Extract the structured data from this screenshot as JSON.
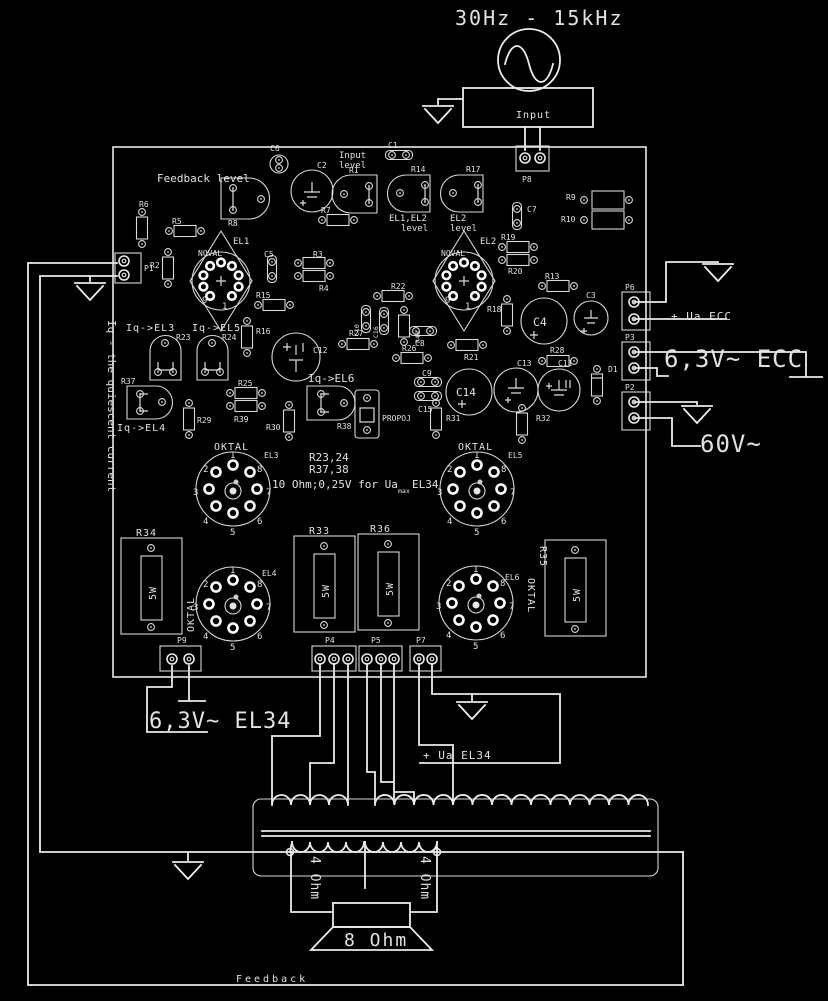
{
  "top": {
    "range": "30Hz - 15kHz",
    "source_label": "Input"
  },
  "right": {
    "ua_ecc": "+ Ua ECC",
    "heater_ecc": "6,3V~ ECC",
    "bias": "60V~"
  },
  "bottom": {
    "heater_el34": "6,3V~ EL34",
    "ua_el34": "+ Ua EL34",
    "feedback": "Feedback"
  },
  "output": {
    "tap_left": "4 Ohm",
    "tap_right": "4 Ohm",
    "speaker": "8 Ohm"
  },
  "pcb": {
    "side_note": "Iq - the quiescent current",
    "noval": "NOVAL",
    "oktal": "OKTAL",
    "watt": "5W",
    "pins_noval": [
      "9",
      "1"
    ],
    "pins_oktal": [
      "1",
      "2",
      "3",
      "4",
      "5",
      "6",
      "7",
      "8"
    ],
    "labels": {
      "feedback_level": "Feedback level",
      "input_level_1": "Input",
      "input_level_2": "level",
      "el1el2_level_1": "EL1,EL2",
      "el1el2_level_2": "level",
      "el2_level_1": "EL2",
      "el2_level_2": "level",
      "iq_el3": "Iq->EL3",
      "iq_el5": "Iq->EL5",
      "iq_el4": "Iq->EL4",
      "iq_el6": "Iq->EL6",
      "propoj": "PROPOJ"
    },
    "note": {
      "l1": "R23,24",
      "l2": "R37,38",
      "l3": "10 Ohm;0,25V for Ua",
      "l3_sub": "max",
      "l3_end": "EL34"
    },
    "c": {
      "P1": "P1",
      "P2": "P2",
      "P3": "P3",
      "P4": "P4",
      "P5": "P5",
      "P6": "P6",
      "P7": "P7",
      "P8": "P8",
      "P9": "P9",
      "EL1": "EL1",
      "EL2": "EL2",
      "EL3": "EL3",
      "EL4": "EL4",
      "EL5": "EL5",
      "EL6": "EL6",
      "D1": "D1",
      "C1": "C1",
      "C2": "C2",
      "C3": "C3",
      "C4": "C4",
      "C5": "C5",
      "C6": "C6",
      "C7": "C7",
      "C8": "C8",
      "C9": "C9",
      "C10": "C10",
      "C11": "C11",
      "C12": "C12",
      "C13": "C13",
      "C14": "C14",
      "C15": "C15",
      "C16": "C16",
      "R1": "R1",
      "R2": "R2",
      "R3": "R3",
      "R4": "R4",
      "R5": "R5",
      "R6": "R6",
      "R7": "R7",
      "R8": "R8",
      "R9": "R9",
      "R10": "R10",
      "R13": "R13",
      "R14": "R14",
      "R15": "R15",
      "R16": "R16",
      "R17": "R17",
      "R18": "R18",
      "R19": "R19",
      "R20": "R20",
      "R21": "R21",
      "R22": "R22",
      "R23": "R23",
      "R24": "R24",
      "R25": "R25",
      "R26": "R26",
      "R27": "R27",
      "R28": "R28",
      "R29": "R29",
      "R30": "R30",
      "R31": "R31",
      "R32": "R32",
      "R33": "R33",
      "R34": "R34",
      "R35": "R35",
      "R36": "R36",
      "R37": "R37",
      "R38": "R38",
      "R39": "R39",
      "R40": "R40"
    }
  }
}
